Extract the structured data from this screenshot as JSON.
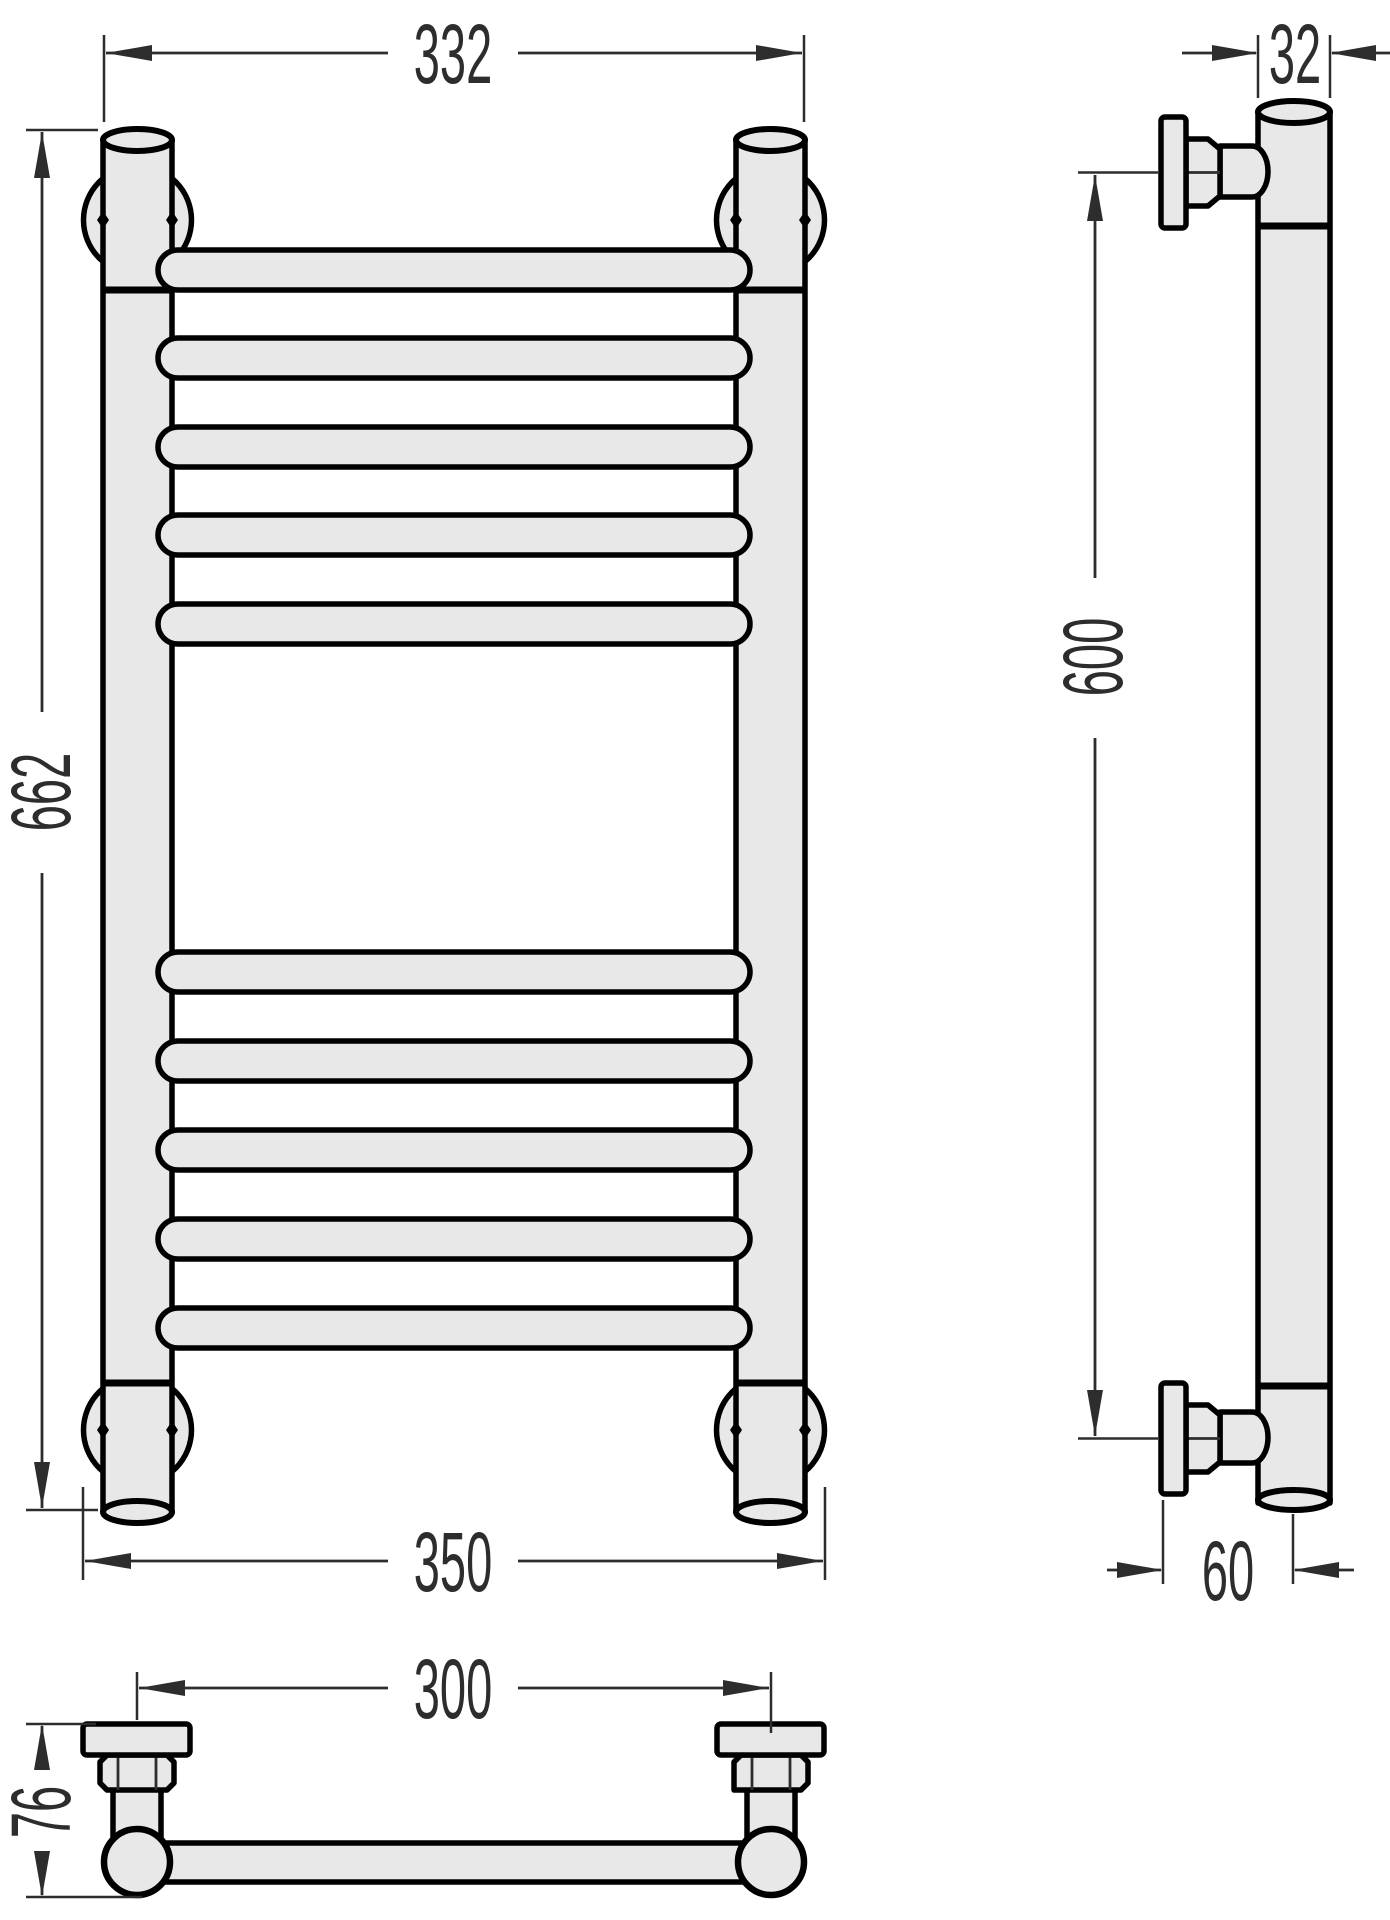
{
  "drawing": {
    "type": "technical-dimension-drawing",
    "subject": "ladder-style towel rail radiator, three orthographic views",
    "views": {
      "front": {
        "label": "front view",
        "rung_count": 10,
        "rung_groups": [
          5,
          5
        ],
        "dims": {
          "width_top": "332",
          "height": "662",
          "width_bottom": "350"
        }
      },
      "side": {
        "label": "side view",
        "dims": {
          "pipe_diameter": "32",
          "bracket_spacing": "600",
          "wall_offset": "60"
        }
      },
      "bottom": {
        "label": "bottom view",
        "dims": {
          "axis_spacing": "300",
          "depth": "76"
        }
      }
    },
    "colors": {
      "background": "#ffffff",
      "part_fill": "#e8e8e8",
      "outline": "#000000",
      "dimension": "#2d2d2d"
    }
  }
}
